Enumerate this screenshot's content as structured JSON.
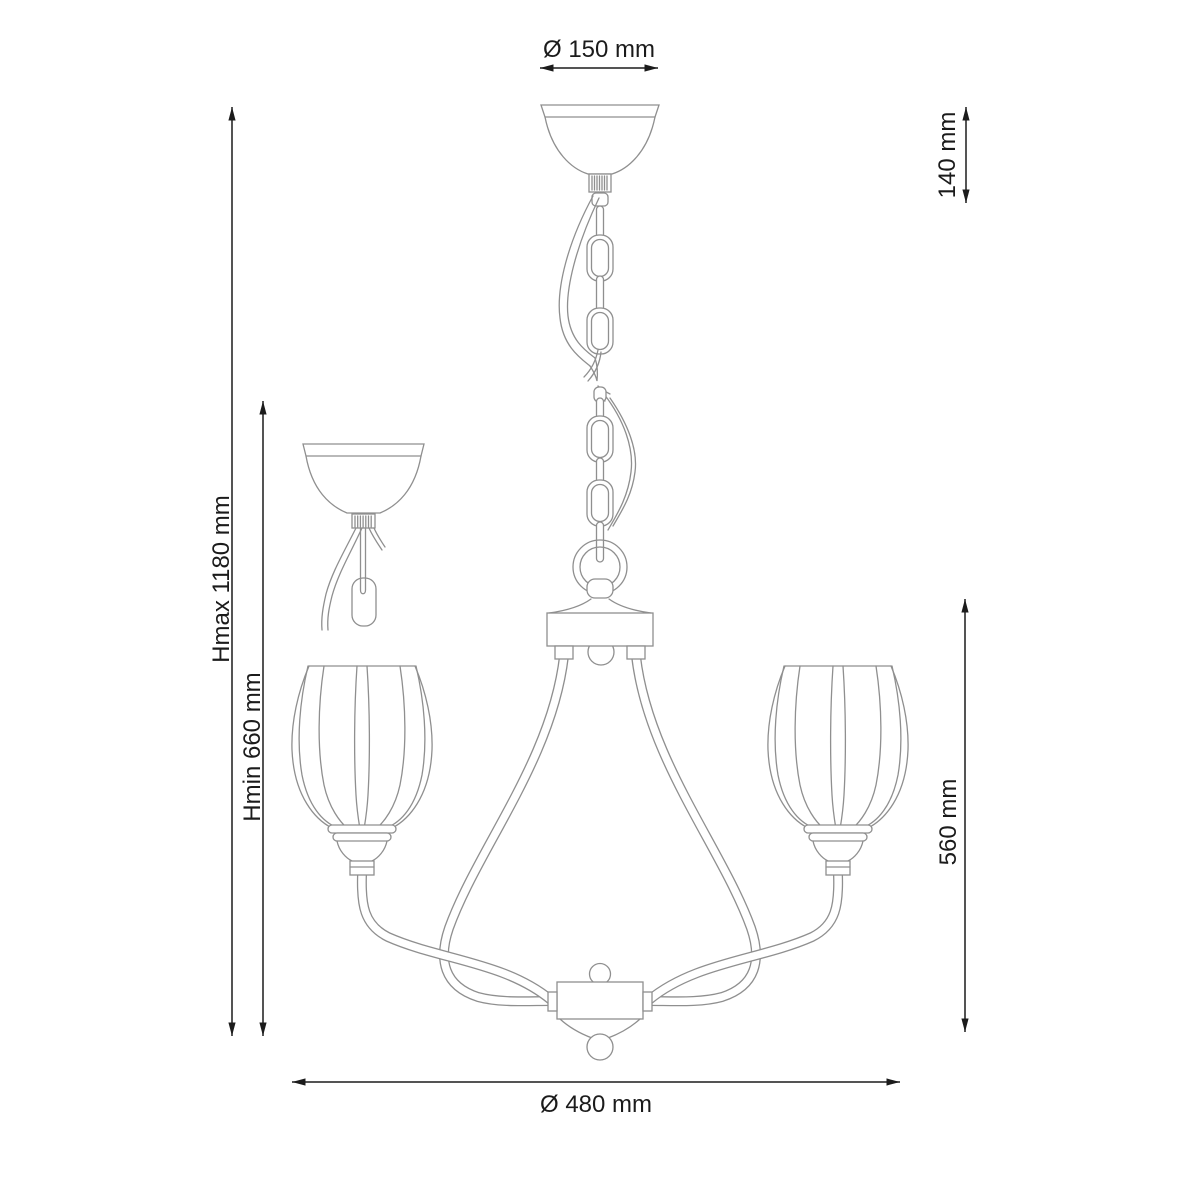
{
  "drawing": {
    "kind": "chandelier dimension diagram",
    "dimensions": {
      "canopy_diameter": {
        "label": "Ø 150 mm",
        "value_mm": 150,
        "orientation": "horizontal"
      },
      "canopy_height": {
        "label": "140 mm",
        "value_mm": 140,
        "orientation": "vertical"
      },
      "height_max": {
        "label": "Hmax 1180 mm",
        "value_mm": 1180,
        "orientation": "vertical"
      },
      "height_min": {
        "label": "Hmin 660 mm",
        "value_mm": 660,
        "orientation": "vertical"
      },
      "fixture_height": {
        "label": "560 mm",
        "value_mm": 560,
        "orientation": "vertical"
      },
      "fixture_diameter": {
        "label": "Ø 480 mm",
        "value_mm": 480,
        "orientation": "horizontal"
      }
    },
    "colors": {
      "background": "#ffffff",
      "fixture_line": "#8f8f8f",
      "dimension_line": "#1c1c1c",
      "text": "#1b1b1b"
    }
  }
}
